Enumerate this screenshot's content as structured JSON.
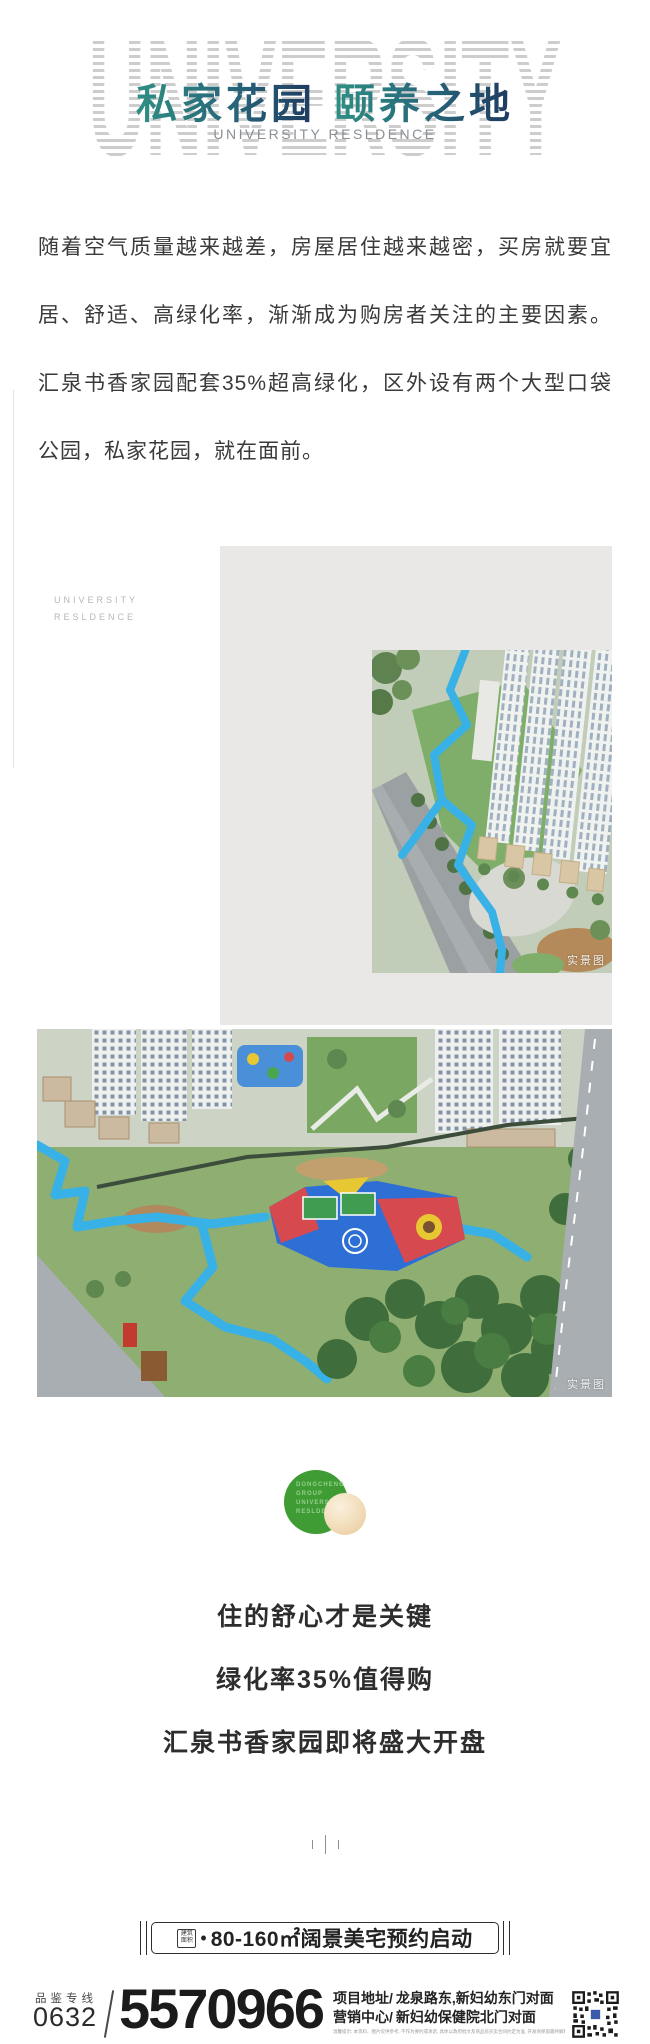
{
  "header": {
    "watermark": "UNIVERSITY",
    "title_left": "私家花园",
    "title_right": "颐养之地",
    "subtitle": "UNIVERSITY RESLDENCE"
  },
  "intro": {
    "lines": [
      "随着空气质量越来越差，房屋居住越来越密，买房就要宜",
      "居、舒适、高绿化率，渐渐成为购房者关注的主要因素。",
      "汇泉书香家园配套35%超高绿化，区外设有两个大型口袋",
      "公园，私家花园，就在面前。"
    ]
  },
  "side_label": {
    "line1": "UNIVERSITY",
    "line2": "RESLDENCE"
  },
  "photos": {
    "photo1_tag": "实景图",
    "photo2_tag": "实景图"
  },
  "logo": {
    "lines": [
      "DONGCHENG",
      "GROUP",
      "UNIVERSITY",
      "RESLDENCE"
    ]
  },
  "slogans": [
    "住的舒心才是关键",
    "绿化率35%值得购",
    "汇泉书香家园即将盛大开盘"
  ],
  "banner": {
    "seal_line1": "建筑",
    "seal_line2": "面积",
    "bullet": "•",
    "text": "80-160㎡阔景美宅预约启动"
  },
  "footer": {
    "hotline_label": "品鉴专线",
    "area_code": "0632",
    "phone": "5570966",
    "address1_label": "项目地址/",
    "address1": "龙泉路东,新妇幼东门对面",
    "address2_label": "营销中心/",
    "address2": "新妇幼保健院北门对面",
    "fineprint": "温馨提示: 本资料、图片仅供参考, 不作为要约或承诺, 具体以政府批文及商品房买卖合同约定为准, 开发商保留最终解释权。"
  },
  "colors": {
    "accent_teal": "#2f8f83",
    "accent_navy": "#1e3a5f",
    "path_blue": "#38b1e6",
    "logo_green": "#3f9c35",
    "panel_gray": "#e9e8e6"
  }
}
